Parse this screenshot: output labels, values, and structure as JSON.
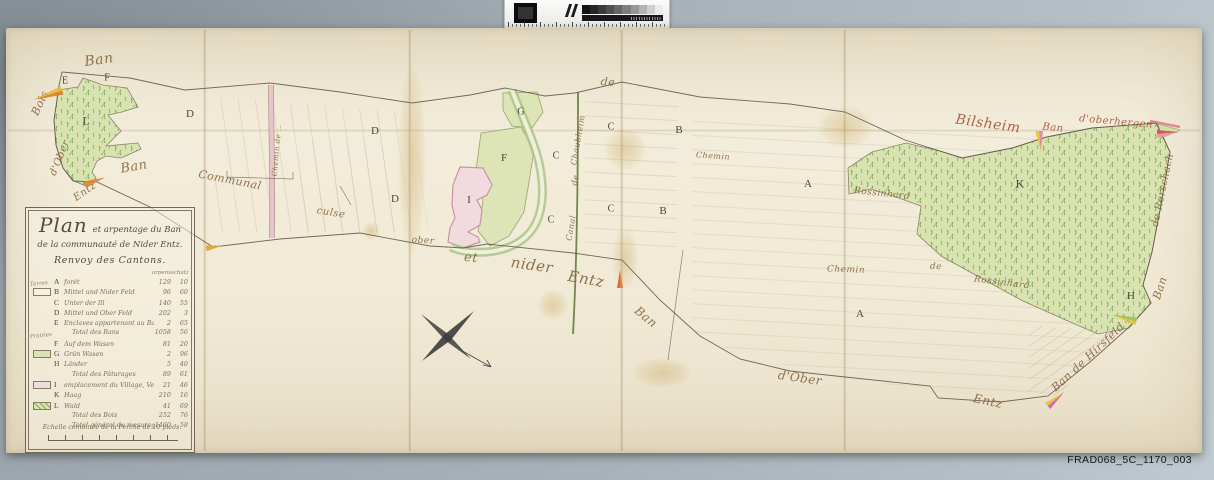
{
  "archive": {
    "reference": "FRAD068_5C_1170_003"
  },
  "palette": {
    "label_brown": "#87653f",
    "label_red": "#a5563a",
    "forest_fill": "#d9e3b1",
    "forest_speckle": "#76a14e",
    "village_pink": "#f2dbdf",
    "river_green": "#a9c284",
    "canal_green": "#74864c",
    "road_pink": "#e9c3cb",
    "ink": "#5a5348"
  },
  "calibration": {
    "steps": [
      "#141414",
      "#262626",
      "#3a3a3a",
      "#4f4f4f",
      "#666666",
      "#7e7e7e",
      "#989898",
      "#b3b3b3",
      "#cfcfcf",
      "#ebebeb"
    ]
  },
  "map": {
    "cartouche": {
      "title_big": "Plan",
      "title_rest": "et arpentage du Ban",
      "line2": "de la communauté de Nider Entz.",
      "line3": "Renvoy des Cantons.",
      "col_headers": [
        "arpens",
        "schatz"
      ],
      "rows": [
        {
          "letter": "A",
          "desc": "forêt",
          "v1": "129",
          "v2": "10"
        },
        {
          "letter": "B",
          "desc": "Mittel und Nider Feld",
          "v1": "96",
          "v2": "60",
          "swatch": "plain",
          "group": "Terres"
        },
        {
          "letter": "C",
          "desc": "Unter der Ill",
          "v1": "140",
          "v2": "55"
        },
        {
          "letter": "D",
          "desc": "Mittel und Ober Feld",
          "v1": "202",
          "v2": "3"
        },
        {
          "letter": "E",
          "desc": "Enclaves appartenant au Ban de …",
          "v1": "2",
          "v2": "65"
        },
        {
          "total": "Total des Bans",
          "v1": "1058",
          "v2": "56"
        },
        {
          "letter": "F",
          "desc": "Auf dem Wasen",
          "v1": "81",
          "v2": "20",
          "group": "Prairies"
        },
        {
          "letter": "G",
          "desc": "Grün Wasen",
          "v1": "2",
          "v2": "96",
          "swatch": "green"
        },
        {
          "letter": "H",
          "desc": "Länder",
          "v1": "5",
          "v2": "40"
        },
        {
          "total": "Total des Pâturages",
          "v1": "89",
          "v2": "61"
        },
        {
          "letter": "I",
          "desc": "emplacement du Village, Vergers &c.",
          "v1": "21",
          "v2": "46",
          "swatch": "pink"
        },
        {
          "letter": "K",
          "desc": "Haag",
          "v1": "210",
          "v2": "16"
        },
        {
          "letter": "L",
          "desc": "Wald",
          "v1": "41",
          "v2": "69",
          "swatch": "forest"
        },
        {
          "total": "Total des Bois",
          "v1": "252",
          "v2": "76"
        },
        {
          "total": "Total général du mesurage",
          "v1": "1460",
          "v2": "58"
        }
      ],
      "scale_label": "Echelle combinée de la Perche de 10 pieds."
    },
    "letters": [
      {
        "t": "E",
        "x": 65,
        "y": 81,
        "s": 10
      },
      {
        "t": "F",
        "x": 107,
        "y": 78,
        "s": 10
      },
      {
        "t": "L",
        "x": 86,
        "y": 121,
        "s": 12
      },
      {
        "t": "D",
        "x": 190,
        "y": 114,
        "s": 11
      },
      {
        "t": "D",
        "x": 375,
        "y": 131,
        "s": 11
      },
      {
        "t": "D",
        "x": 395,
        "y": 199,
        "s": 11
      },
      {
        "t": "G",
        "x": 521,
        "y": 112,
        "s": 10
      },
      {
        "t": "F",
        "x": 504,
        "y": 158,
        "s": 11
      },
      {
        "t": "I",
        "x": 469,
        "y": 200,
        "s": 11
      },
      {
        "t": "C",
        "x": 611,
        "y": 127,
        "s": 10
      },
      {
        "t": "C",
        "x": 556,
        "y": 156,
        "s": 10
      },
      {
        "t": "C",
        "x": 611,
        "y": 209,
        "s": 10
      },
      {
        "t": "C",
        "x": 551,
        "y": 220,
        "s": 10
      },
      {
        "t": "B",
        "x": 679,
        "y": 130,
        "s": 11
      },
      {
        "t": "B",
        "x": 663,
        "y": 211,
        "s": 11
      },
      {
        "t": "A",
        "x": 808,
        "y": 184,
        "s": 11
      },
      {
        "t": "A",
        "x": 860,
        "y": 314,
        "s": 11
      },
      {
        "t": "K",
        "x": 1020,
        "y": 184,
        "s": 12
      },
      {
        "t": "H",
        "x": 1131,
        "y": 296,
        "s": 11
      }
    ],
    "labels": [
      {
        "t": "Ban",
        "x": 99,
        "y": 60,
        "r": -8,
        "s": 14
      },
      {
        "t": "Bois",
        "x": 40,
        "y": 103,
        "r": -65,
        "s": 11
      },
      {
        "t": "Ban",
        "x": 134,
        "y": 167,
        "r": -10,
        "s": 13
      },
      {
        "t": "d'Ober",
        "x": 60,
        "y": 158,
        "r": -68,
        "s": 10
      },
      {
        "t": "Entz",
        "x": 85,
        "y": 192,
        "r": -35,
        "s": 10
      },
      {
        "t": "Communal",
        "x": 230,
        "y": 180,
        "r": 11,
        "s": 11
      },
      {
        "t": "culse",
        "x": 331,
        "y": 213,
        "r": 9,
        "s": 10
      },
      {
        "t": "ober",
        "x": 423,
        "y": 241,
        "r": 4,
        "s": 9
      },
      {
        "t": "et",
        "x": 471,
        "y": 258,
        "r": 6,
        "s": 13
      },
      {
        "t": "nider",
        "x": 532,
        "y": 265,
        "r": 8,
        "s": 15
      },
      {
        "t": "Entz",
        "x": 586,
        "y": 279,
        "r": 10,
        "s": 15
      },
      {
        "t": "de",
        "x": 608,
        "y": 82,
        "r": 4,
        "s": 11
      },
      {
        "t": "Chemin",
        "x": 713,
        "y": 156,
        "r": 4,
        "s": 8
      },
      {
        "t": "Ban",
        "x": 646,
        "y": 317,
        "r": 40,
        "s": 12
      },
      {
        "t": "d'Ober",
        "x": 800,
        "y": 378,
        "r": 8,
        "s": 12
      },
      {
        "t": "Entz",
        "x": 988,
        "y": 401,
        "r": 12,
        "s": 12
      },
      {
        "t": "Bilsheim",
        "x": 988,
        "y": 124,
        "r": 8,
        "s": 14,
        "c": "r"
      },
      {
        "t": "Ban",
        "x": 1053,
        "y": 128,
        "r": 6,
        "s": 10,
        "c": "r"
      },
      {
        "t": "d'oberhergen",
        "x": 1116,
        "y": 122,
        "r": 5,
        "s": 10,
        "c": "r"
      },
      {
        "t": "Rossinhard",
        "x": 882,
        "y": 194,
        "r": 6,
        "s": 9
      },
      {
        "t": "Chemin",
        "x": 846,
        "y": 270,
        "r": 2,
        "s": 9
      },
      {
        "t": "de",
        "x": 936,
        "y": 267,
        "r": 2,
        "s": 9
      },
      {
        "t": "Rossinhard",
        "x": 1002,
        "y": 283,
        "r": 7,
        "s": 9
      },
      {
        "t": "de Rorschach",
        "x": 1163,
        "y": 190,
        "r": -78,
        "s": 10
      },
      {
        "t": "Ban",
        "x": 1160,
        "y": 288,
        "r": -72,
        "s": 11
      },
      {
        "t": "Ban de Hirsfeld",
        "x": 1088,
        "y": 357,
        "r": -43,
        "s": 11
      },
      {
        "t": "Chemin de …",
        "x": 277,
        "y": 150,
        "r": -85,
        "s": 7
      },
      {
        "t": "Chaubheim",
        "x": 578,
        "y": 140,
        "r": -80,
        "s": 8
      },
      {
        "t": "de",
        "x": 575,
        "y": 180,
        "r": -80,
        "s": 8
      },
      {
        "t": "Canal",
        "x": 571,
        "y": 228,
        "r": -80,
        "s": 8
      }
    ],
    "wedges": [
      {
        "x": 48,
        "y": 95,
        "r": -18,
        "w": 30,
        "h": 9,
        "c1": "#e7bb3a",
        "c2": "#dd7f2e"
      },
      {
        "x": 95,
        "y": 181,
        "r": 160,
        "w": 22,
        "h": 7,
        "c1": "#dd8a33",
        "c2": "#dd8a33"
      },
      {
        "x": 214,
        "y": 247,
        "r": 170,
        "w": 16,
        "h": 6,
        "c1": "#e2a238",
        "c2": "#e2a238"
      },
      {
        "x": 620,
        "y": 279,
        "r": 90,
        "w": 18,
        "h": 6,
        "c1": "#dd7f2e",
        "c2": "#e05a4a"
      },
      {
        "x": 1040,
        "y": 141,
        "r": -95,
        "w": 20,
        "h": 8,
        "c1": "#e7c43a",
        "c2": "#e088a0"
      },
      {
        "x": 1168,
        "y": 133,
        "r": 175,
        "w": 22,
        "h": 8,
        "c1": "#ef93a8",
        "c2": "#d44f55"
      },
      {
        "x": 1124,
        "y": 318,
        "r": 15,
        "w": 26,
        "h": 8,
        "c1": "#9cc060",
        "c2": "#e7c43a"
      },
      {
        "x": 1056,
        "y": 399,
        "r": 140,
        "w": 22,
        "h": 8,
        "c1": "#cf62b0",
        "c2": "#e7c43a"
      }
    ]
  }
}
